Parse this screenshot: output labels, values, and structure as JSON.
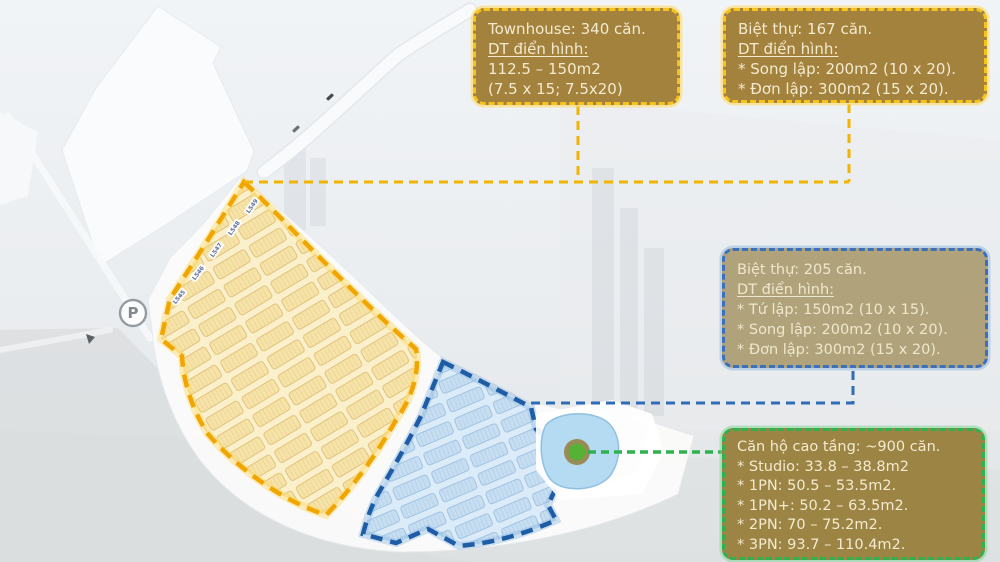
{
  "map": {
    "parking_label": "P",
    "lot_labels": [
      "L549",
      "L548",
      "L547",
      "L546",
      "L545"
    ]
  },
  "callouts": {
    "townhouse": {
      "lines": [
        "Townhouse: 340 căn.",
        "DT điển hình:",
        "112.5 – 150m2",
        "(7.5 x 15; 7.5x20)"
      ]
    },
    "villa_yellow": {
      "lines": [
        "Biệt thự: 167 căn.",
        "DT điển hình:",
        "* Song lập: 200m2 (10 x 20).",
        "* Đơn lập: 300m2 (15 x 20)."
      ]
    },
    "villa_blue": {
      "lines": [
        "Biệt thự: 205 căn.",
        "DT điển hình:",
        "* Tứ lập: 150m2 (10 x 15).",
        "* Song lập: 200m2 (10 x 20).",
        "* Đơn lập:  300m2 (15 x 20)."
      ]
    },
    "apartment": {
      "lines": [
        "Căn hộ cao tầng: ~900 căn.",
        "* Studio: 33.8 – 38.8m2",
        "* 1PN: 50.5 – 53.5m2.",
        "* 1PN+: 50.2 – 63.5m2.",
        "* 2PN: 70 – 75.2m2.",
        "* 3PN: 93.7 – 110.4m2."
      ]
    },
    "colors": {
      "townhouse_accent": "#f2b303",
      "villa_blue_accent": "#2e6cb8",
      "apartment_accent": "#2fb14f",
      "gold_box_bg": "#a3823e",
      "tan_box_bg": "#b0a37b",
      "olive_box_bg": "#9c8444"
    }
  }
}
